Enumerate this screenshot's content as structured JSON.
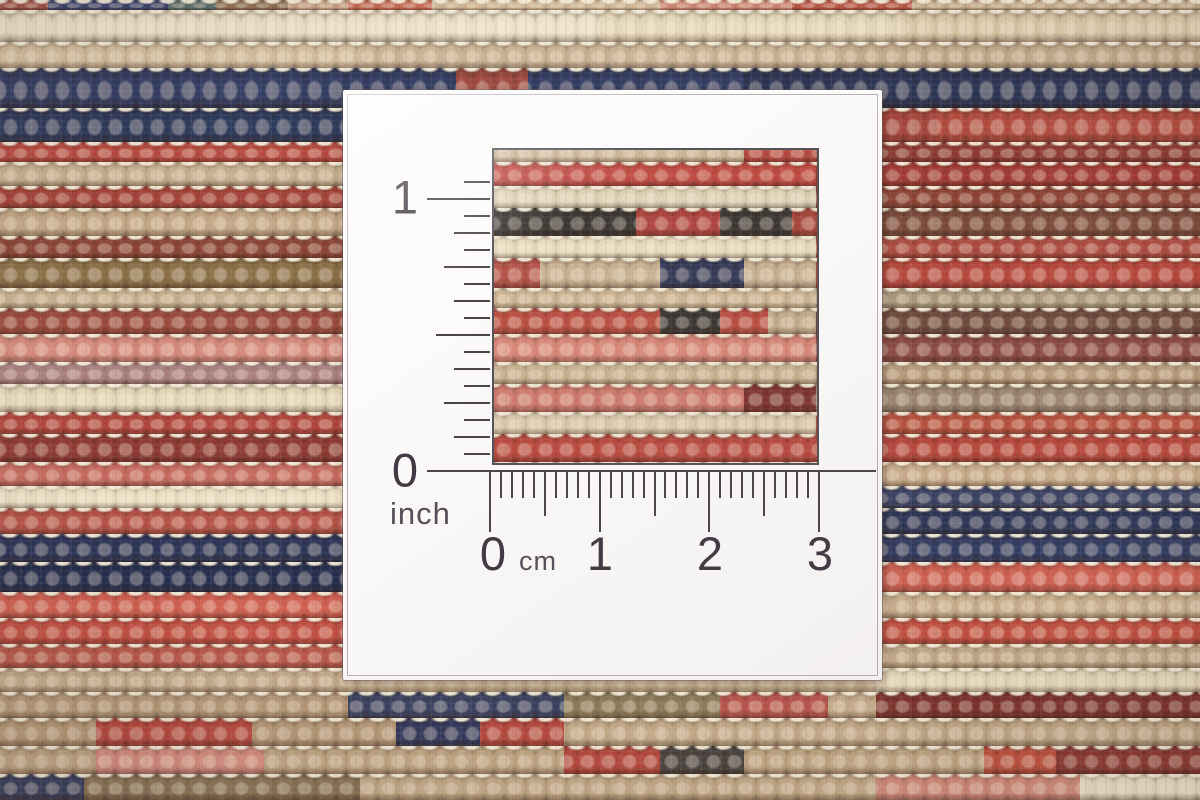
{
  "ruler_card": {
    "inch_scale": {
      "max_label": "1",
      "zero_label": "0",
      "unit": "inch"
    },
    "cm_scale": {
      "tick_labels": [
        "0",
        "1",
        "2",
        "3"
      ],
      "unit": "cm"
    }
  },
  "palette": {
    "card_white": "#fcfbfa",
    "ruler_ink": "#4a454c",
    "label_ink": "#3f3a42",
    "carpet_cream": "#ebdfc6",
    "carpet_tan": "#c9b191",
    "carpet_red": "#b5483d",
    "carpet_maroon": "#8c3a33",
    "carpet_salmon": "#d88a7b",
    "carpet_navy": "#2e3758",
    "carpet_charcoal": "#3a3531",
    "carpet_brown": "#8a6f4a",
    "warp_white": "#f4ebd7"
  },
  "carpet": {
    "knot_width": 21,
    "rows": [
      {
        "h": 10,
        "s": [
          [
            "#9c4f44",
            4
          ],
          [
            "#37406b",
            14
          ],
          [
            "#566a66",
            18
          ],
          [
            "#8a6a4e",
            24
          ],
          [
            "#c59f83",
            29
          ],
          [
            "#c1664f",
            36
          ],
          [
            "#cbb291",
            55
          ],
          [
            "#c87f6d",
            66
          ],
          [
            "#b5503f",
            76
          ],
          [
            "#c3a988",
            100
          ]
        ]
      },
      {
        "h": 32,
        "s": [
          [
            "#ebdfc6",
            50
          ],
          [
            "#e4d6b8",
            75
          ],
          [
            "#dbc9a9",
            100
          ]
        ]
      },
      {
        "h": 26,
        "s": [
          [
            "#d2bd9d",
            30
          ],
          [
            "#c8b294",
            70
          ],
          [
            "#c0a98a",
            100
          ]
        ]
      },
      {
        "h": 40,
        "s": [
          [
            "#333d62",
            38
          ],
          [
            "#9e4a41",
            44
          ],
          [
            "#333d62",
            62
          ],
          [
            "#2c3554",
            100
          ]
        ]
      },
      {
        "h": 34,
        "s": [
          [
            "#2e3a5c",
            29
          ],
          [
            "#c9b494",
            36
          ],
          [
            "#e3d4b4",
            46
          ],
          [
            "#b04a3e",
            62
          ],
          [
            "#a5453c",
            78
          ],
          [
            "#b04a3e",
            100
          ]
        ]
      },
      {
        "h": 20,
        "s": [
          [
            "#b5493f",
            29
          ],
          [
            "#c9b293",
            62
          ],
          [
            "#b5493f",
            68
          ],
          [
            "#8c3a33",
            100
          ]
        ]
      },
      {
        "h": 24,
        "s": [
          [
            "#c4ae8e",
            29
          ],
          [
            "#c04a42",
            68
          ],
          [
            "#a03a34",
            100
          ]
        ]
      },
      {
        "h": 22,
        "s": [
          [
            "#a34238",
            29
          ],
          [
            "#ddd0b4",
            68
          ],
          [
            "#8c4335",
            100
          ]
        ]
      },
      {
        "h": 28,
        "s": [
          [
            "#c2a685",
            29
          ],
          [
            "#3b3733",
            53
          ],
          [
            "#b04540",
            60
          ],
          [
            "#3b3733",
            66
          ],
          [
            "#a8473c",
            73
          ],
          [
            "#7a4a3a",
            100
          ]
        ]
      },
      {
        "h": 22,
        "s": [
          [
            "#8a4436",
            29
          ],
          [
            "#e6dabd",
            68
          ],
          [
            "#ab4a3f",
            100
          ]
        ]
      },
      {
        "h": 30,
        "s": [
          [
            "#8a6f48",
            29
          ],
          [
            "#33395a",
            34
          ],
          [
            "#b5544a",
            45
          ],
          [
            "#c9b292",
            55
          ],
          [
            "#343a58",
            62
          ],
          [
            "#c9b292",
            68
          ],
          [
            "#b5473d",
            100
          ]
        ]
      },
      {
        "h": 20,
        "s": [
          [
            "#c3ad8c",
            29
          ],
          [
            "#cbb493",
            68
          ],
          [
            "#a9977c",
            100
          ]
        ]
      },
      {
        "h": 26,
        "s": [
          [
            "#9a4a3c",
            29
          ],
          [
            "#c5ae8d",
            41
          ],
          [
            "#bb4f43",
            55
          ],
          [
            "#3a3733",
            60
          ],
          [
            "#bb4f43",
            64
          ],
          [
            "#c5ae8d",
            68
          ],
          [
            "#6e4a3e",
            100
          ]
        ]
      },
      {
        "h": 28,
        "s": [
          [
            "#d4897c",
            29
          ],
          [
            "#2f3556",
            34
          ],
          [
            "#d98878",
            68
          ],
          [
            "#8a4a44",
            100
          ]
        ]
      },
      {
        "h": 22,
        "s": [
          [
            "#a97f80",
            29
          ],
          [
            "#c9b392",
            68
          ],
          [
            "#b59879",
            100
          ]
        ]
      },
      {
        "h": 28,
        "s": [
          [
            "#e3d6b8",
            29
          ],
          [
            "#7e352f",
            33
          ],
          [
            "#cf7a6d",
            62
          ],
          [
            "#7e352f",
            68
          ],
          [
            "#9a8570",
            100
          ]
        ]
      },
      {
        "h": 22,
        "s": [
          [
            "#b0453c",
            29
          ],
          [
            "#d8c9ab",
            68
          ],
          [
            "#b5503f",
            100
          ]
        ]
      },
      {
        "h": 28,
        "s": [
          [
            "#8e3a33",
            29
          ],
          [
            "#bb4a40",
            68
          ],
          [
            "#b5473d",
            100
          ]
        ]
      },
      {
        "h": 24,
        "s": [
          [
            "#c56a5e",
            29
          ],
          [
            "#ccb697",
            68
          ],
          [
            "#c5a988",
            100
          ]
        ]
      },
      {
        "h": 22,
        "s": [
          [
            "#e8dcc0",
            29
          ],
          [
            "#d5c3a3",
            68
          ],
          [
            "#3a4263",
            100
          ]
        ]
      },
      {
        "h": 26,
        "s": [
          [
            "#b55247",
            29
          ],
          [
            "#c9b191",
            68
          ],
          [
            "#2e3758",
            100
          ]
        ]
      },
      {
        "h": 28,
        "s": [
          [
            "#2c3557",
            29
          ],
          [
            "#39406b",
            68
          ],
          [
            "#323c60",
            100
          ]
        ]
      },
      {
        "h": 30,
        "s": [
          [
            "#262f4f",
            29
          ],
          [
            "#6b6b80",
            45
          ],
          [
            "#cbb595",
            73
          ],
          [
            "#cc5f52",
            100
          ]
        ]
      },
      {
        "h": 26,
        "s": [
          [
            "#cf5f51",
            29
          ],
          [
            "#d0bfa0",
            73
          ],
          [
            "#c6ac8b",
            100
          ]
        ]
      },
      {
        "h": 26,
        "s": [
          [
            "#c24f44",
            29
          ],
          [
            "#e2d3b5",
            73
          ],
          [
            "#c04f41",
            100
          ]
        ]
      },
      {
        "h": 24,
        "s": [
          [
            "#b8584a",
            29
          ],
          [
            "#c9b393",
            73
          ],
          [
            "#bfa685",
            100
          ]
        ]
      },
      {
        "h": 24,
        "s": [
          [
            "#c3a98a",
            29
          ],
          [
            "#cbb493",
            73
          ],
          [
            "#e0d2b4",
            100
          ]
        ]
      },
      {
        "h": 26,
        "s": [
          [
            "#b59877",
            29
          ],
          [
            "#3a4160",
            47
          ],
          [
            "#8a7a58",
            60
          ],
          [
            "#b5544a",
            69
          ],
          [
            "#c2a887",
            73
          ],
          [
            "#7c332d",
            100
          ]
        ]
      },
      {
        "h": 28,
        "s": [
          [
            "#b59877",
            8
          ],
          [
            "#b5493f",
            21
          ],
          [
            "#b59877",
            33
          ],
          [
            "#33395c",
            40
          ],
          [
            "#b5493f",
            47
          ],
          [
            "#c2a887",
            73
          ],
          [
            "#bfa685",
            100
          ]
        ]
      },
      {
        "h": 28,
        "s": [
          [
            "#c0a583",
            8
          ],
          [
            "#d58d7f",
            22
          ],
          [
            "#c0a583",
            47
          ],
          [
            "#b5493f",
            55
          ],
          [
            "#4a4440",
            62
          ],
          [
            "#c0a583",
            82
          ],
          [
            "#bf5240",
            88
          ],
          [
            "#8c3a33",
            100
          ]
        ]
      },
      {
        "h": 26,
        "s": [
          [
            "#39405e",
            7
          ],
          [
            "#8a7458",
            30
          ],
          [
            "#c2a887",
            73
          ],
          [
            "#d08a7a",
            90
          ],
          [
            "#e8dcc2",
            100
          ]
        ]
      }
    ]
  }
}
